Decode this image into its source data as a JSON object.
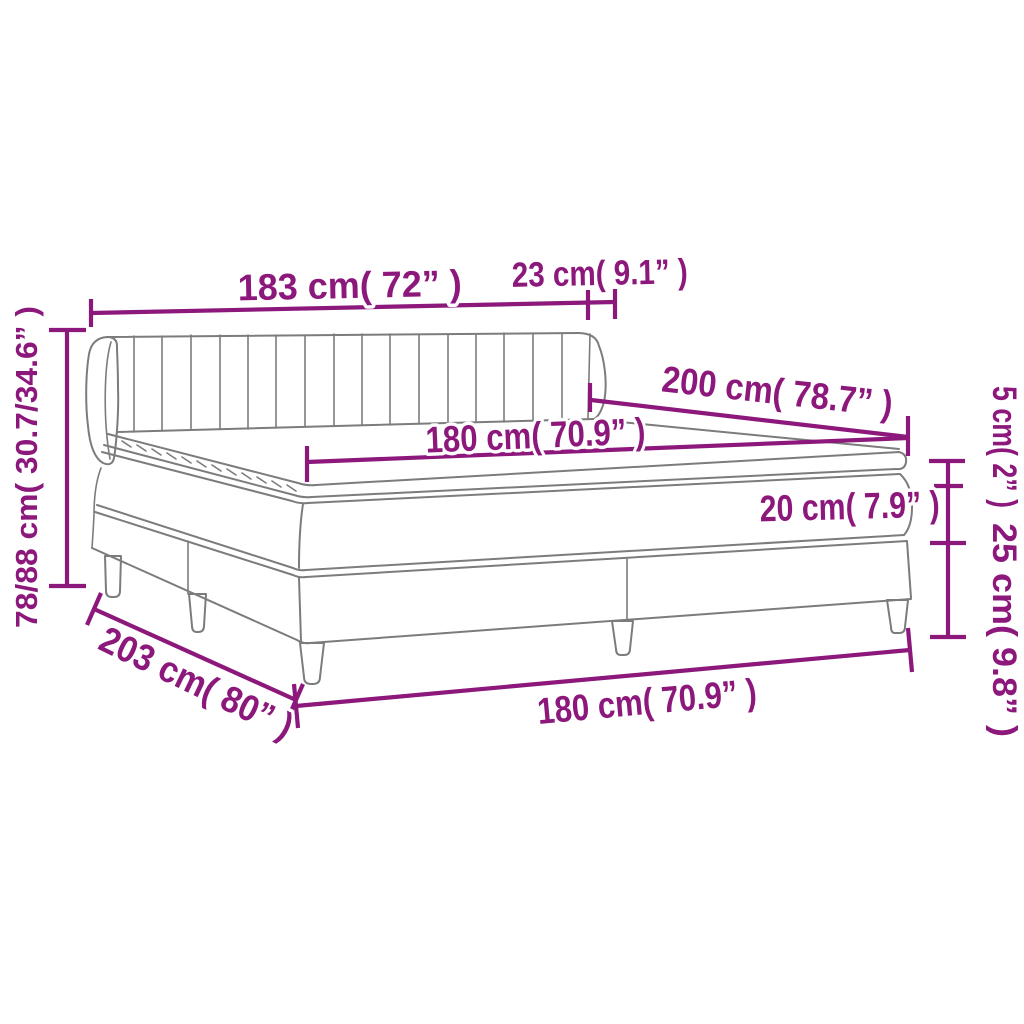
{
  "diagram": {
    "title": "box-spring-bed-dimension-diagram",
    "colors": {
      "dimension_accent": "#8C187C",
      "drawing_outline": "#7C7C7C",
      "background": "#FFFFFF"
    },
    "labels": {
      "headboard_width": "183 cm( 72” )",
      "headboard_depth": "23 cm( 9.1” )",
      "bed_length": "200 cm( 78.7” )",
      "mattress_width_top": "180 cm( 70.9” )",
      "topper_height": "5 cm( 2” )",
      "mattress_height": "20 cm( 7.9” )",
      "base_height": "25 cm( 9.8” )",
      "total_height": "78/88 cm( 30.7/34.6” )",
      "bed_depth": "203 cm( 80” )",
      "base_width": "180 cm( 70.9” )"
    }
  }
}
